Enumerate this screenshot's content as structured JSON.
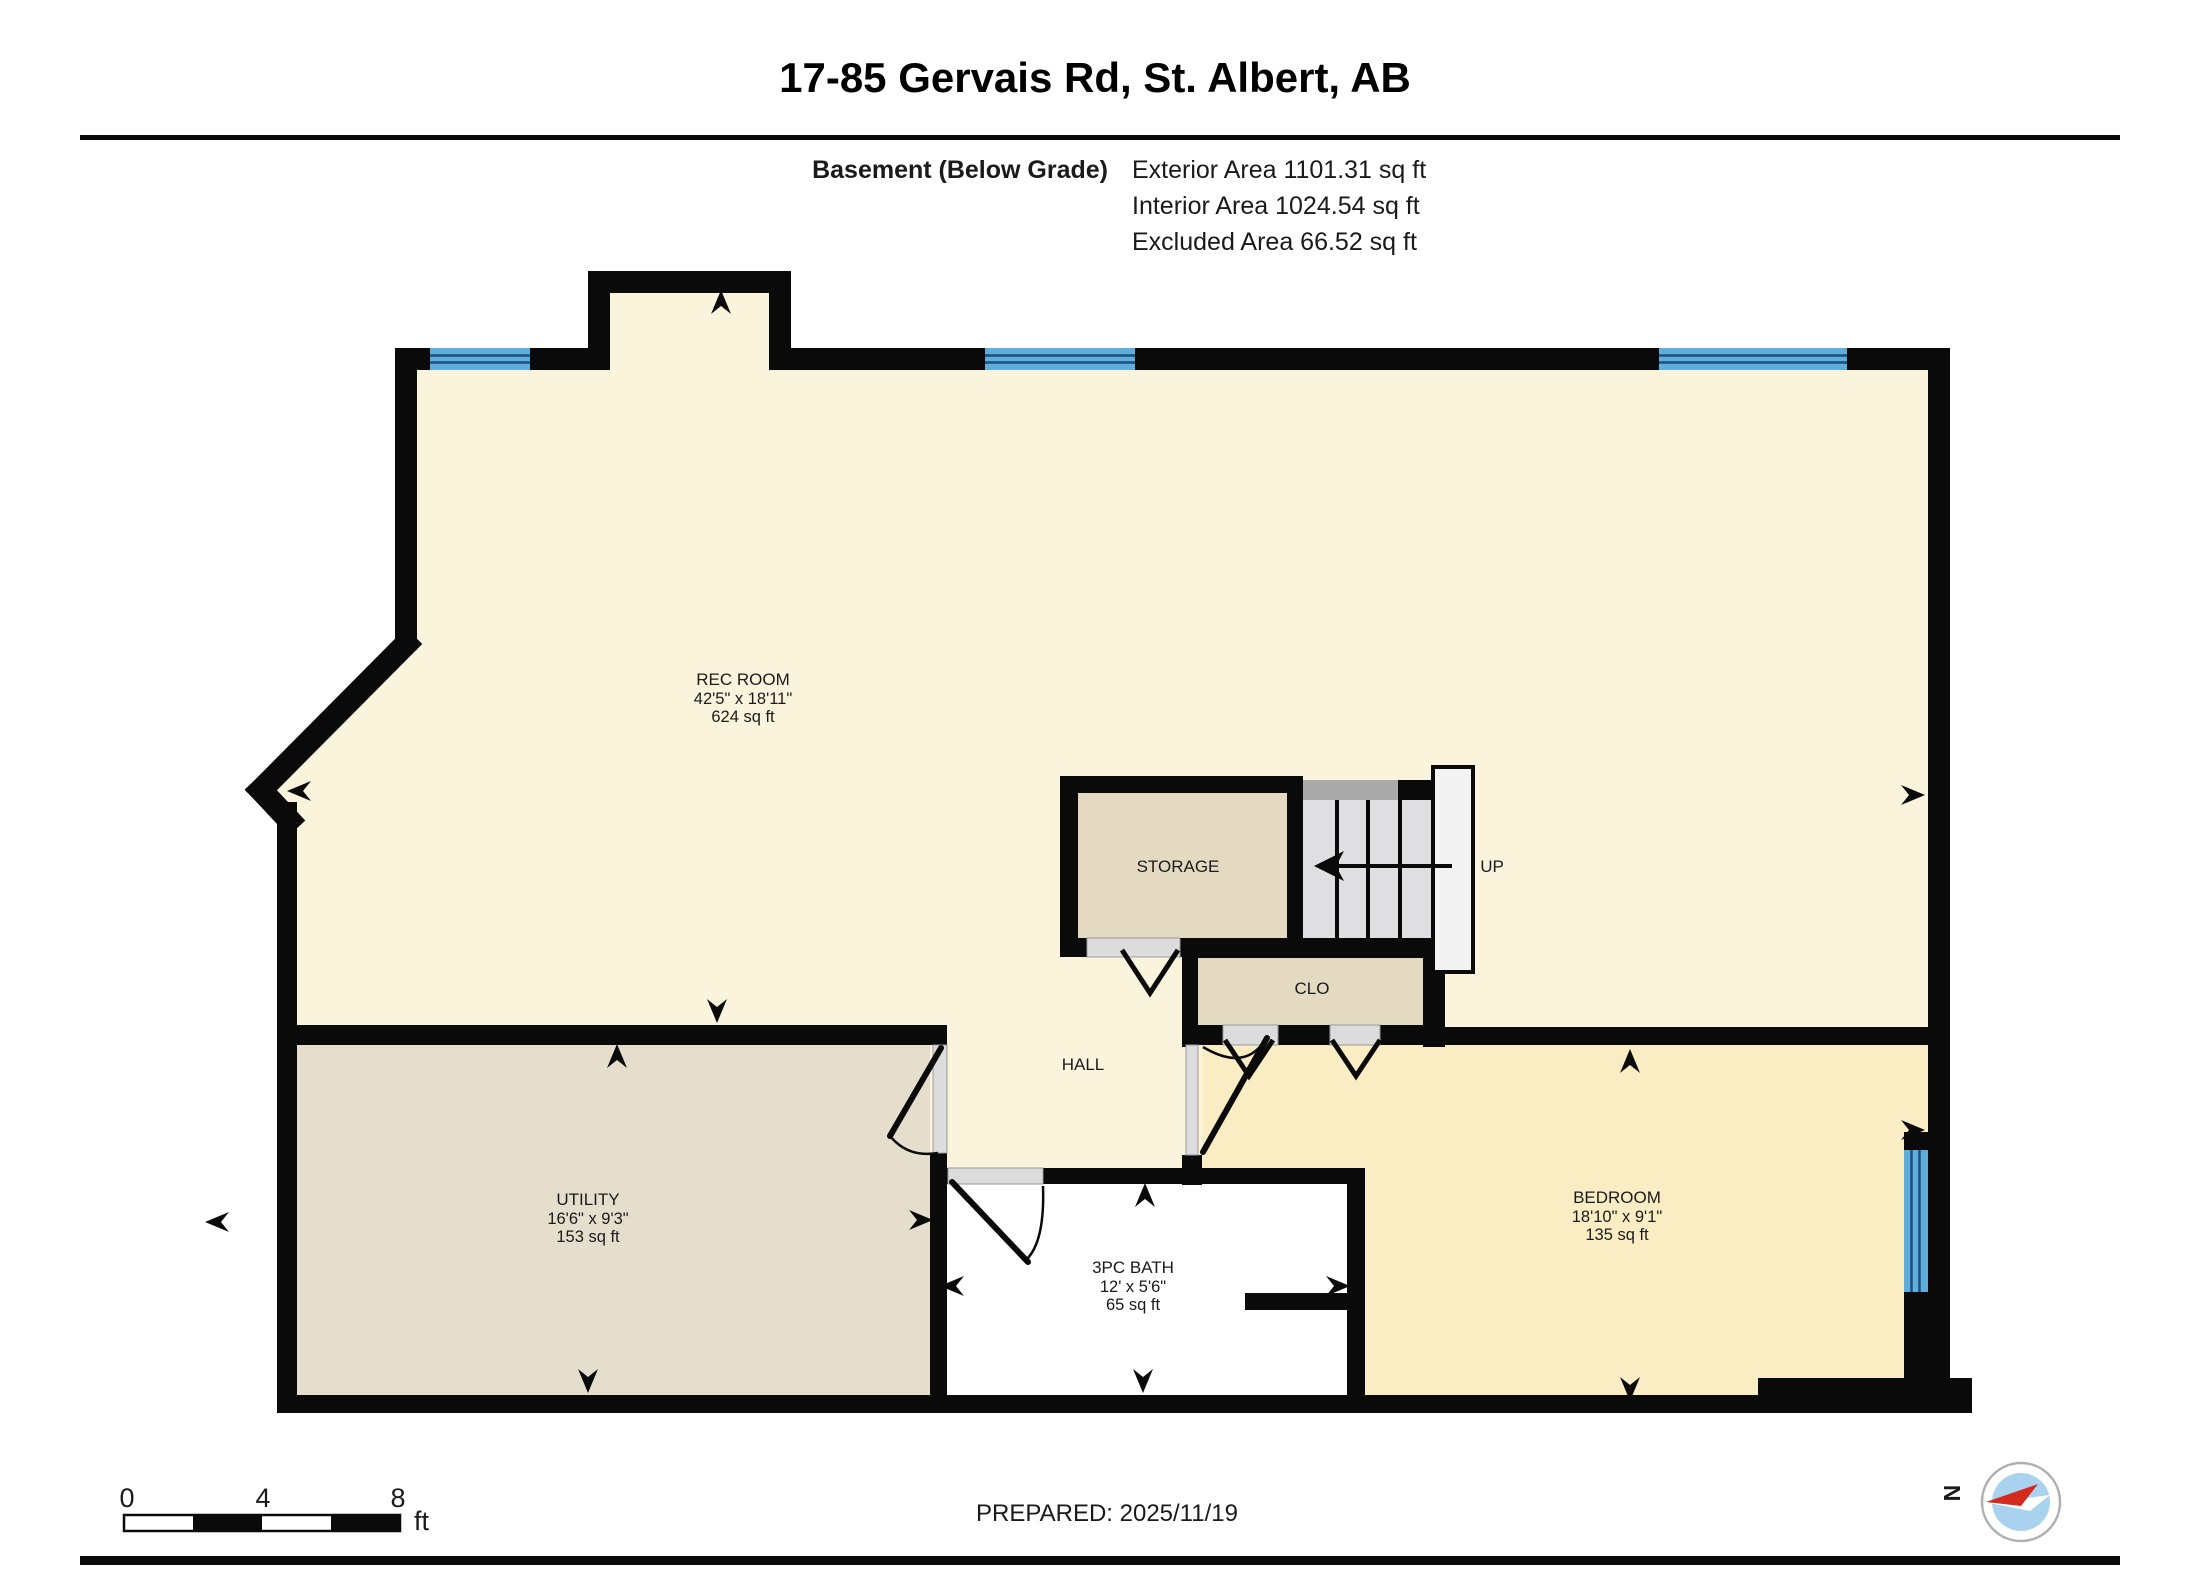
{
  "header": {
    "title": "17-85 Gervais Rd, St. Albert, AB",
    "floor_label": "Basement (Below Grade)",
    "stats": {
      "exterior": "Exterior Area 1101.31 sq ft",
      "interior": "Interior Area 1024.54 sq ft",
      "excluded": "Excluded Area 66.52 sq ft"
    }
  },
  "rooms": {
    "rec_room": {
      "name": "REC ROOM",
      "dims": "42'5\" x 18'11\"",
      "area": "624 sq ft"
    },
    "utility": {
      "name": "UTILITY",
      "dims": "16'6\" x 9'3\"",
      "area": "153 sq ft"
    },
    "bath": {
      "name": "3PC BATH",
      "dims": "12' x 5'6\"",
      "area": "65 sq ft"
    },
    "bedroom": {
      "name": "BEDROOM",
      "dims": "18'10\" x 9'1\"",
      "area": "135 sq ft"
    },
    "storage": {
      "name": "STORAGE"
    },
    "closet": {
      "name": "CLO"
    },
    "hall": {
      "name": "HALL"
    }
  },
  "stairs": {
    "label": "UP"
  },
  "scale_bar": {
    "tick_0": "0",
    "tick_4": "4",
    "tick_8": "8",
    "unit": "ft"
  },
  "footer": {
    "prepared": "PREPARED: 2025/11/19"
  },
  "compass": {
    "north": "N"
  },
  "colors": {
    "wall": "#0a0a0a",
    "cream": "#FBF4DC",
    "bedroom_fill": "#FAEDC4",
    "tan": "#E4DAC2",
    "utility_fill": "#E5DECD",
    "bath_fill": "#FFFFFF",
    "stairs_fill": "#DFDFE2",
    "stairs_band": "#A9A9A9",
    "landing_fill": "#F3F3F3",
    "window_blue": "#5FADDB",
    "window_line": "#1D4E7E",
    "door_opening": "#DCDCDC",
    "compass_blue": "#A9D2EE",
    "compass_red": "#D42B1E"
  }
}
